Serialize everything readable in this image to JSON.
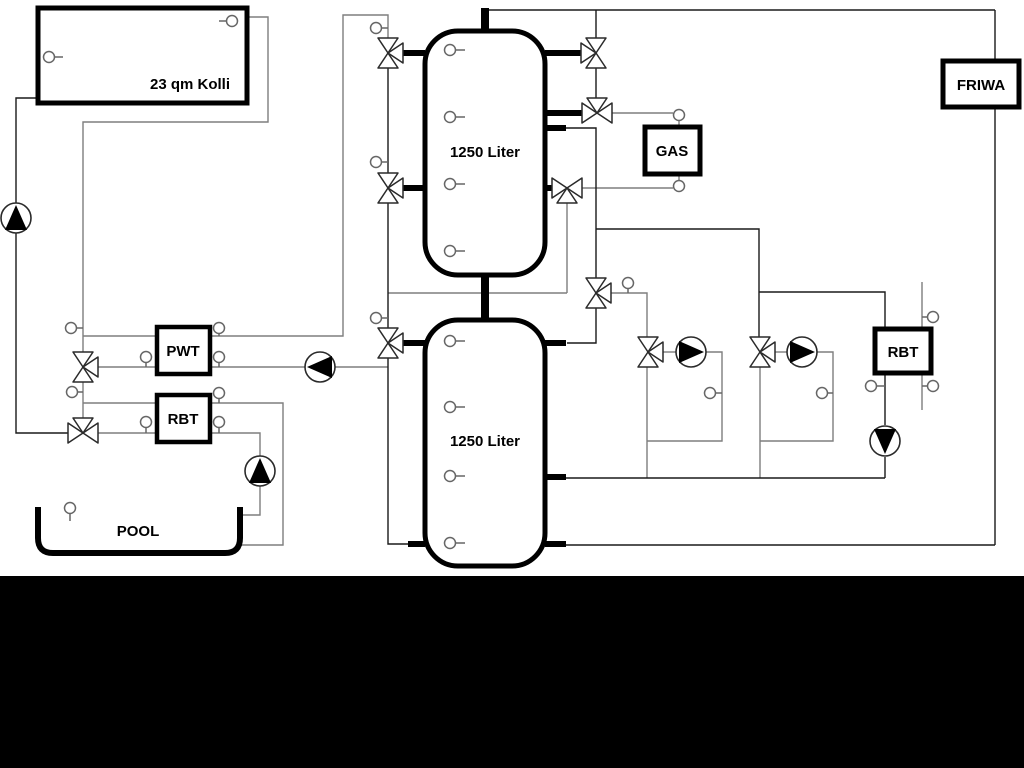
{
  "labels": {
    "collector": "23 qm Kolli",
    "tank1": "1250 Liter",
    "tank2": "1250 Liter",
    "gas": "GAS",
    "friwa": "FRIWA",
    "pwt": "PWT",
    "rbt_left": "RBT",
    "rbt_right": "RBT",
    "pool": "POOL"
  },
  "colors": {
    "background": "#ffffff",
    "letterbox_bar": "#000000",
    "primary_line": "#1a1a1a",
    "secondary_line": "#7e7e7e",
    "component_fill": "#ffffff"
  },
  "icons": {
    "pumps": [
      {
        "name": "solar-pump-icon",
        "flow_direction": "up"
      },
      {
        "name": "buffer-charge-pump-icon",
        "flow_direction": "left"
      },
      {
        "name": "pool-pump-icon",
        "flow_direction": "up"
      },
      {
        "name": "heating-circuit-1-pump-icon",
        "flow_direction": "right"
      },
      {
        "name": "heating-circuit-2-pump-icon",
        "flow_direction": "right"
      },
      {
        "name": "rbt-circuit-pump-icon",
        "flow_direction": "down"
      }
    ],
    "valves": [
      {
        "name": "tank1-left-top-valve-icon"
      },
      {
        "name": "tank1-left-mid-valve-icon"
      },
      {
        "name": "tank2-left-top-valve-icon"
      },
      {
        "name": "tank1-right-top-valve-icon"
      },
      {
        "name": "gas-supply-valve-icon"
      },
      {
        "name": "gas-return-valve-icon"
      },
      {
        "name": "tank2-right-top-valve-icon"
      },
      {
        "name": "pwt-branch-valve-icon"
      },
      {
        "name": "pool-branch-valve-icon"
      },
      {
        "name": "heating-circuit-1-mixing-valve-icon"
      },
      {
        "name": "heating-circuit-2-mixing-valve-icon"
      }
    ],
    "sensors": "temperature-sensor-circle-icon"
  }
}
